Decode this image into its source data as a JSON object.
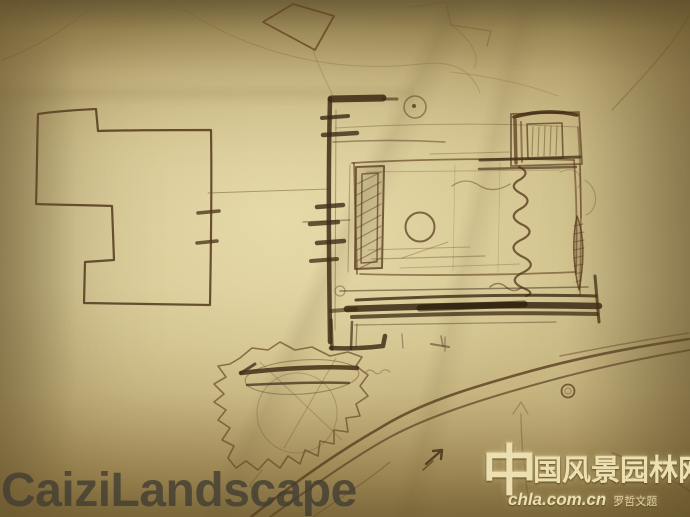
{
  "image": {
    "description": "Photograph of a hand-drawn landscape-architecture concept plan sketch on yellowed paper",
    "kind": "sketch-photo"
  },
  "watermarks": {
    "bottom_left": {
      "text": "CaiziLandscape"
    },
    "bottom_right": {
      "logo_char": "中",
      "site_name_rest": "国风景园林网",
      "url": "chla.com.cn",
      "signature": "罗哲文题"
    }
  },
  "palette": {
    "paper_light": "#cfc08c",
    "paper_mid": "#c2b07b",
    "paper_edge": "#8b7644",
    "ink_heavy": "#33220f",
    "ink_dark": "#3f2b16",
    "ink_medium": "#5d3f22",
    "ink_faint": "#7d5f38",
    "watermark_gray": "rgba(64,60,50,0.78)",
    "watermark_cream": "#ecdfb0"
  },
  "sketch_elements": [
    "tilted square outline (top centre)",
    "L-shaped building footprint (left) with two tick marks",
    "main walled garden plan (centre-right) with edge tick marks",
    "small circle with centre dot (top of plan)",
    "hatched tall rectangle (plan left)",
    "circle in courtyard",
    "vertical squiggle / spring line (plan right)",
    "hatched pavilion rectangle (plan top-right)",
    "heavy dark band along plan bottom",
    "jagged tree / planting blob with bold strokes (bottom centre-left)",
    "sweeping parallel road curves (bottom right)",
    "small circle on road",
    "small dark north-east arrow",
    "faint up arrow",
    "faint construction curves and paper creases"
  ]
}
